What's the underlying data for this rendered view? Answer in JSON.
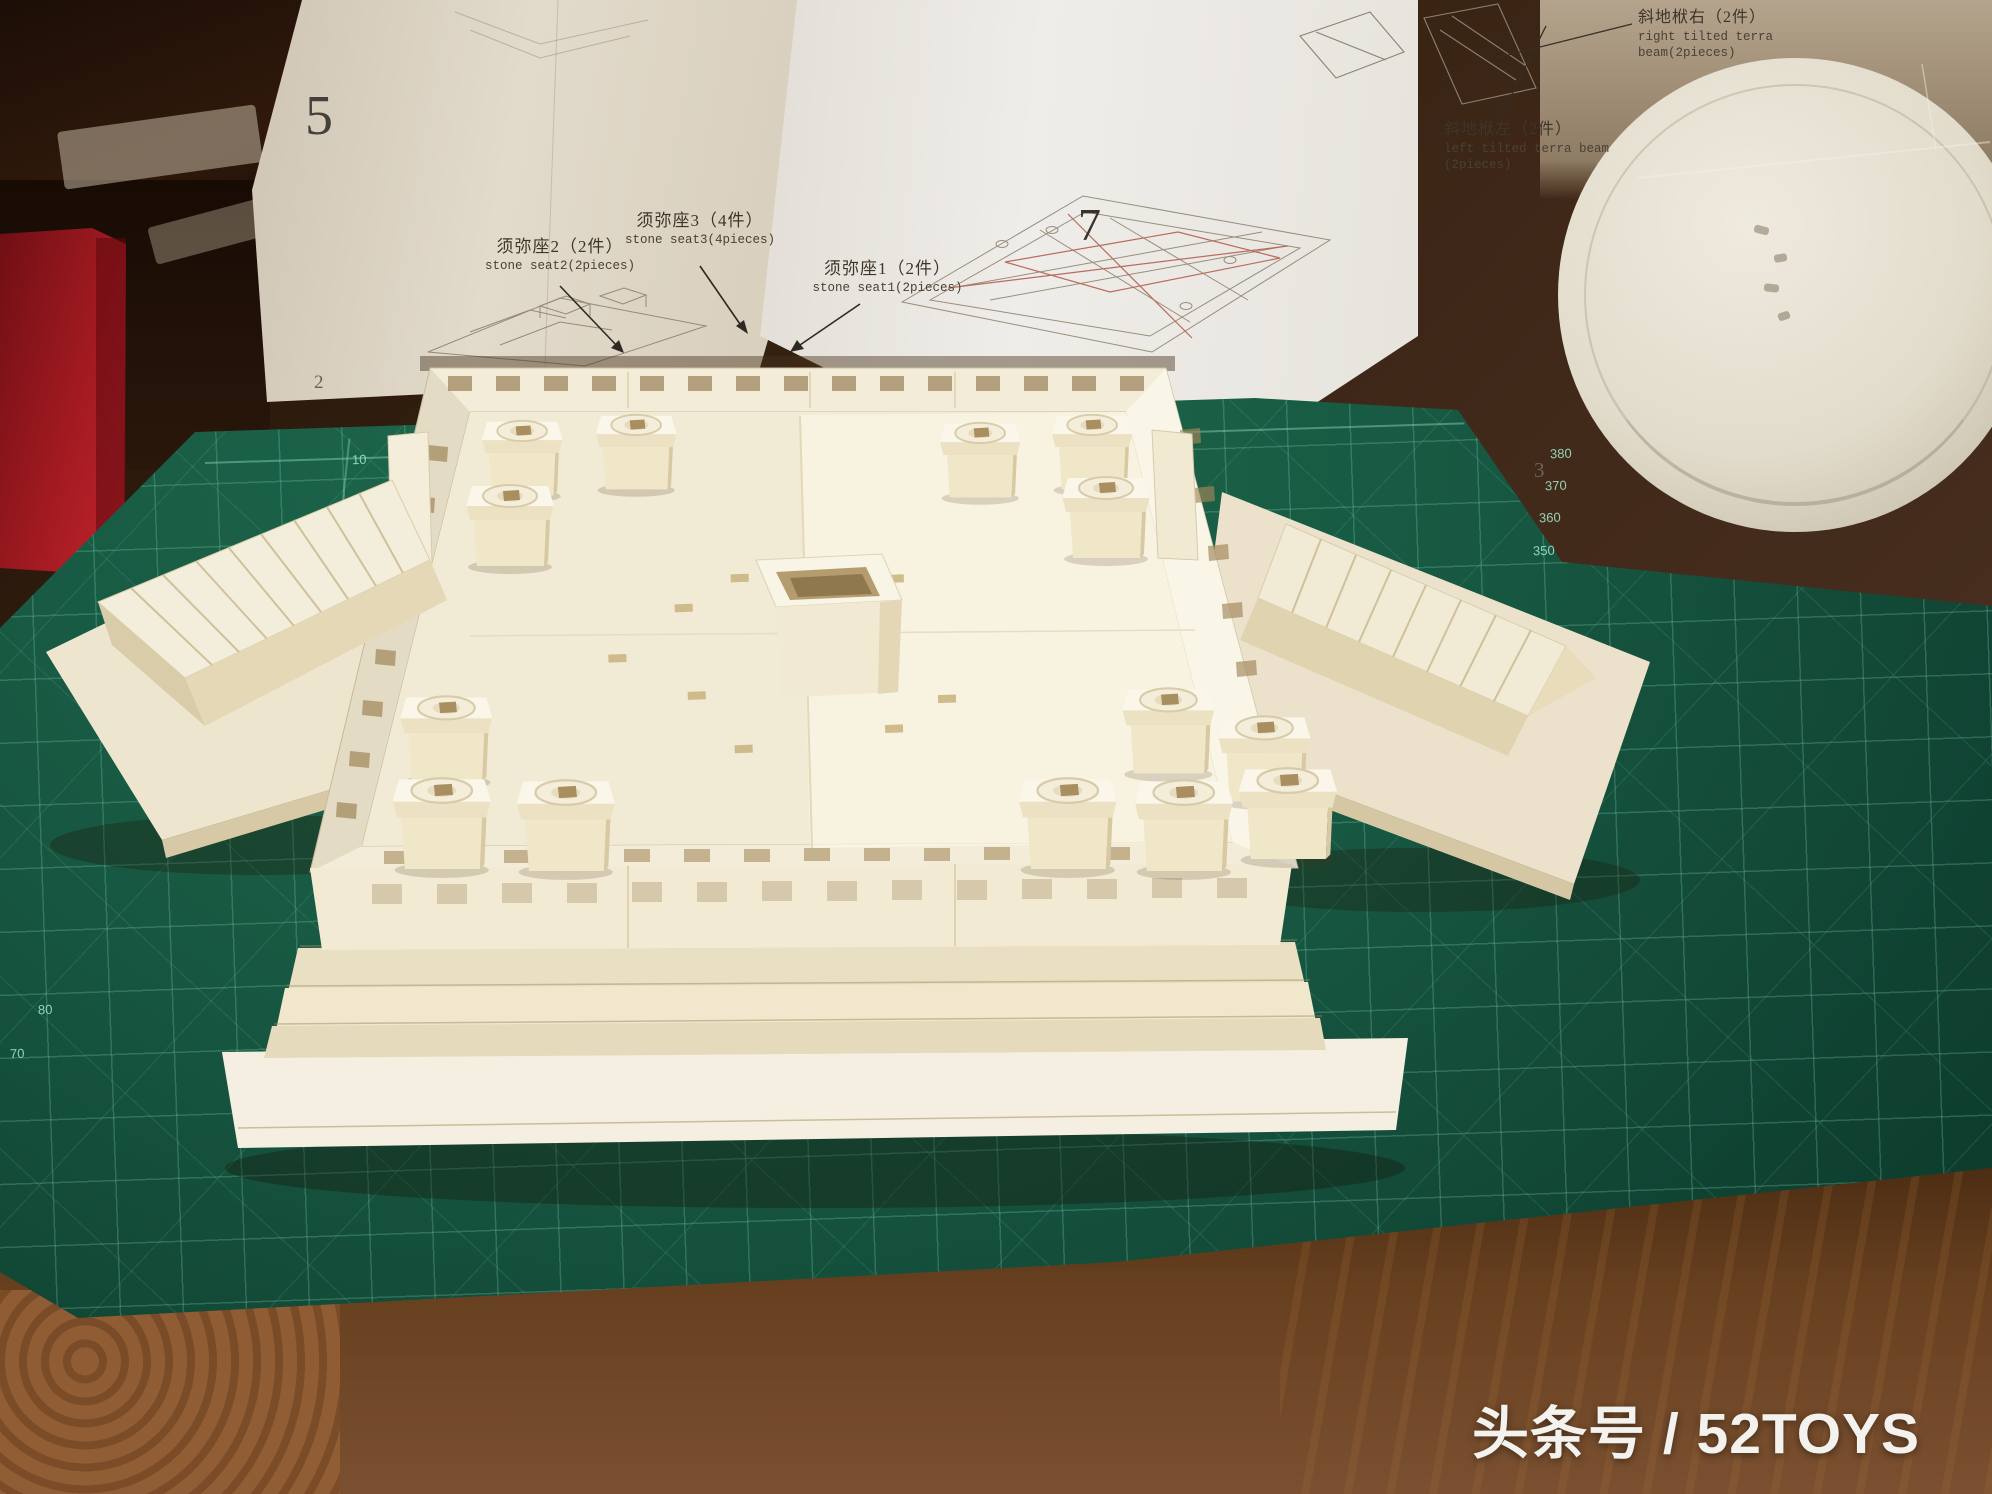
{
  "watermark": {
    "text": "头条号 / 52TOYS"
  },
  "sheets": {
    "left": {
      "step_number": "5",
      "page_number": "2",
      "labels": [
        {
          "zh": "须弥座2（2件）",
          "en": "stone seat2(2pieces)"
        },
        {
          "zh": "须弥座3（4件）",
          "en": "stone seat3(4pieces)"
        },
        {
          "zh": "须弥座1（2件）",
          "en": "stone seat1(2pieces)"
        }
      ]
    },
    "right": {
      "step_number": "7",
      "page_number": "3",
      "labels": [
        {
          "zh": "斜地栿右（2件）",
          "en_line1": "right tilted terra",
          "en_line2": "beam(2pieces)"
        },
        {
          "zh": "斜地栿左（2件）",
          "en_line1": "left tilted terra beam",
          "en_line2": "(2pieces)"
        }
      ]
    }
  },
  "cutting_mat": {
    "brand": "DAFA",
    "product": "CUTTING MAT",
    "model_no": "NO. CM-46 A3",
    "size": "450x300x3mm",
    "top_edge_numbers": [
      "10",
      "20",
      "30"
    ],
    "left_edge_numbers": [
      "270",
      "260",
      "250",
      "240",
      "230"
    ],
    "left_lower_numbers": [
      "80",
      "70"
    ],
    "right_edge_numbers": [
      "380",
      "370",
      "360",
      "350"
    ]
  },
  "colors": {
    "mat_green": "#17553f",
    "mat_lines": "#7fd2bb",
    "model_cream": "#f2ecd8",
    "paper_white": "#ebe8e2",
    "box_red": "#b01e24",
    "wood_brown": "#5a3822",
    "watermark_white": "#f5f3ef"
  }
}
